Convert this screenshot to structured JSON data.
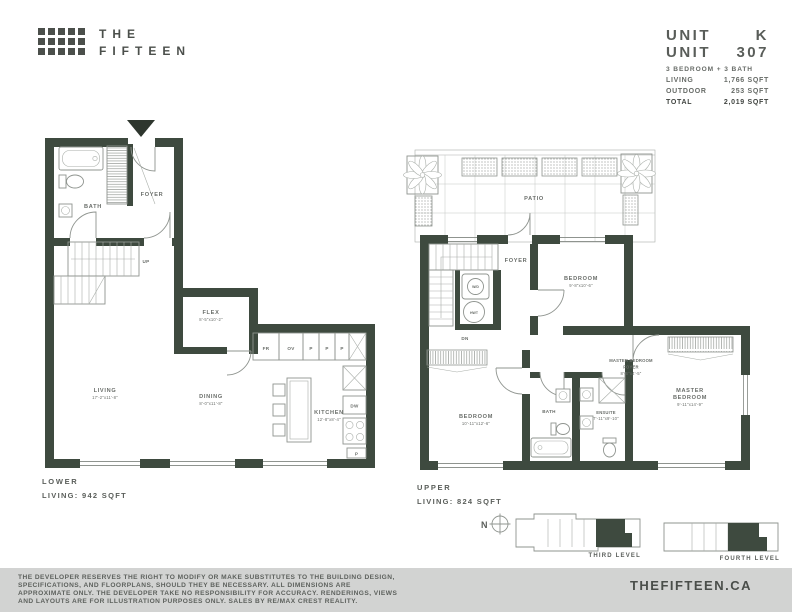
{
  "brand": {
    "line1": "THE",
    "line2": "FIFTEEN"
  },
  "unit_info": {
    "row1_label": "UNIT",
    "row1_value": "K",
    "row2_label": "UNIT",
    "row2_value": "307",
    "config": "3 BEDROOM + 3 BATH",
    "stats": [
      {
        "label": "LIVING",
        "value": "1,766 SQFT"
      },
      {
        "label": "OUTDOOR",
        "value": "253 SQFT"
      },
      {
        "label": "TOTAL",
        "value": "2,019 SQFT"
      }
    ]
  },
  "lower_plan": {
    "title": "LOWER",
    "subtitle": "LIVING: 942 SQFT",
    "rooms": {
      "bath": "BATH",
      "foyer": "FOYER",
      "flex": {
        "name": "FLEX",
        "dims": "8'-5\"x10'-2\""
      },
      "living": {
        "name": "LIVING",
        "dims": "17'-2\"x11'-8\""
      },
      "dining": {
        "name": "DINING",
        "dims": "8'-0\"x11'-8\""
      },
      "kitchen": {
        "name": "KITCHEN",
        "dims": "12'-8\"x8'-4\""
      }
    },
    "markers": {
      "up": "UP",
      "fr": "FR",
      "ov": "OV",
      "p": "P",
      "dw": "DW"
    }
  },
  "upper_plan": {
    "title": "UPPER",
    "subtitle": "LIVING: 824 SQFT",
    "rooms": {
      "patio": "PATIO",
      "foyer": "FOYER",
      "bath": "BATH",
      "bedroom2": {
        "name": "BEDROOM",
        "dims": "9'-8\"x10'-6\""
      },
      "bedroom3": {
        "name": "BEDROOM",
        "dims": "10'-11\"x12'-6\""
      },
      "master_foyer": {
        "line1": "MASTER BEDROOM",
        "line2": "FOYER",
        "dims": "8'-6\"x4'-5\""
      },
      "master": {
        "line1": "MASTER",
        "line2": "BEDROOM",
        "dims": "9'-11\"x14'-9\""
      },
      "ensuite": {
        "name": "ENSUITE",
        "dims": "7'-11\"x9'-10\""
      }
    },
    "markers": {
      "dn": "DN",
      "wd": "W/D",
      "hwt": "HWT"
    }
  },
  "key_plans": {
    "compass": "N",
    "third_label": "THIRD LEVEL",
    "fourth_label": "FOURTH LEVEL"
  },
  "footer": {
    "disclaimer_lines": [
      "THE DEVELOPER RESERVES THE RIGHT TO MODIFY OR MAKE SUBSTITUTES TO THE BUILDING DESIGN,",
      "SPECIFICATIONS, AND FLOORPLANS, SHOULD THEY BE NECESSARY. ALL DIMENSIONS ARE",
      "APPROXIMATE ONLY. THE DEVELOPER TAKE NO RESPONSIBILITY FOR ACCURACY. RENDERINGS, VIEWS",
      "AND LAYOUTS ARE FOR ILLUSTRATION PURPOSES ONLY. SALES BY RE/MAX CREST REALITY."
    ],
    "website": "THEFIFTEEN.CA"
  },
  "colors": {
    "wall": "#3e4a3f",
    "footer_bg": "#d2d3d2",
    "brand": "#4b4f4b"
  }
}
